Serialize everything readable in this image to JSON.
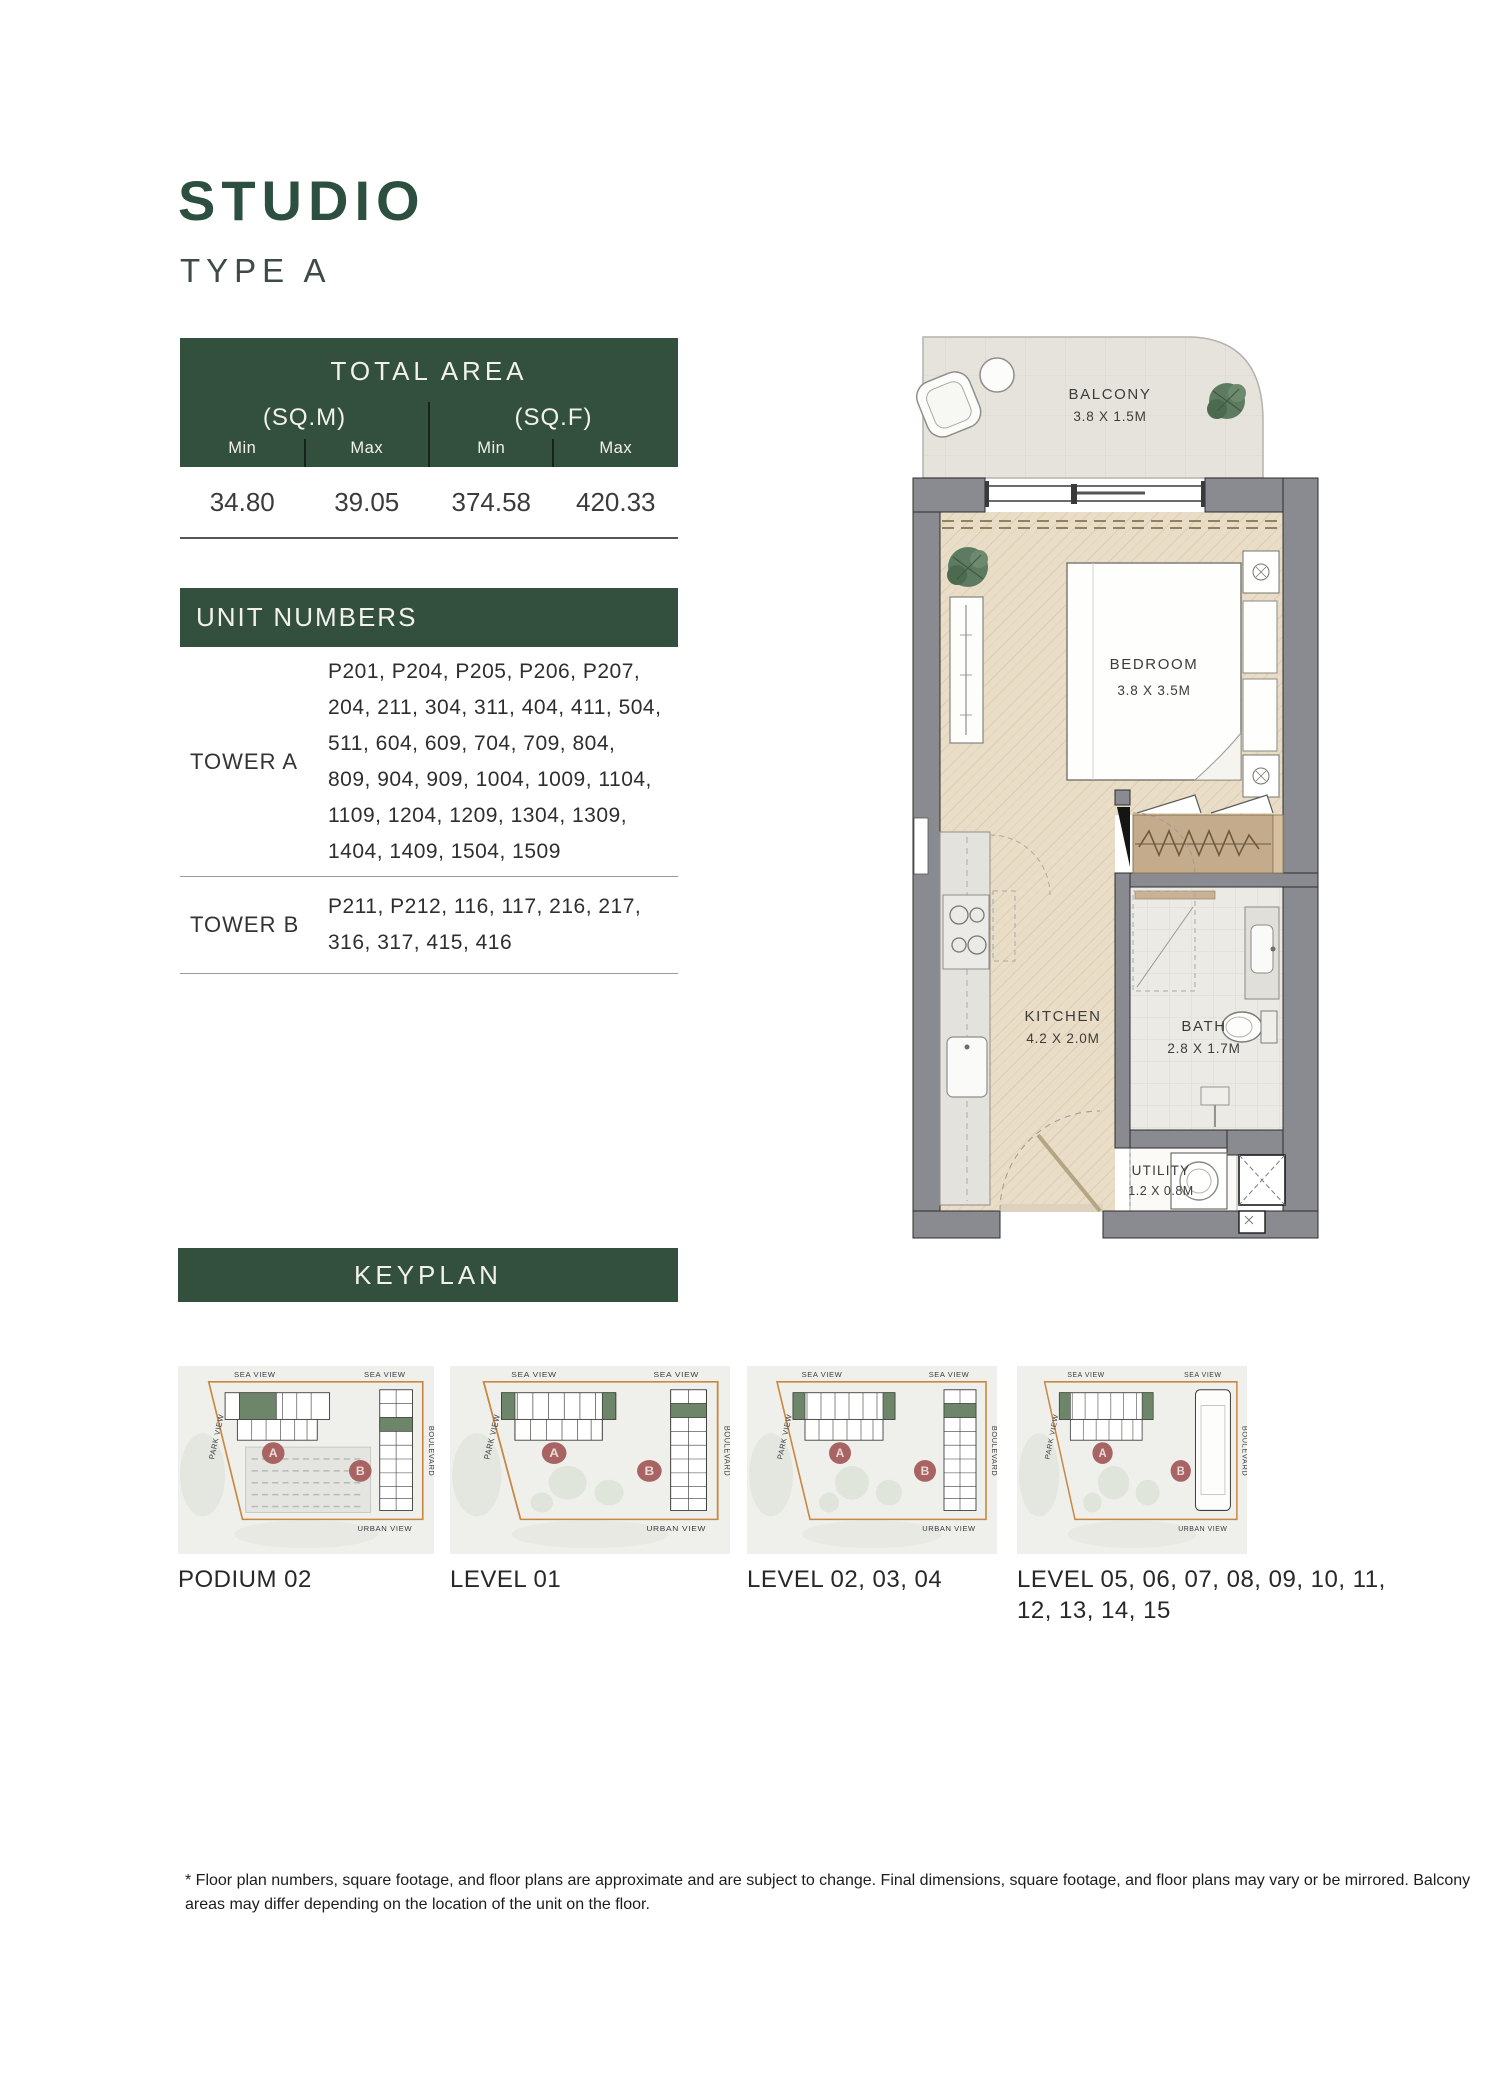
{
  "page": {
    "title": "STUDIO",
    "subtitle": "TYPE A"
  },
  "total_area": {
    "header": "TOTAL AREA",
    "unit_groups": [
      {
        "label": "(SQ.M)"
      },
      {
        "label": "(SQ.F)"
      }
    ],
    "col_headers": [
      "Min",
      "Max",
      "Min",
      "Max"
    ],
    "values": [
      "34.80",
      "39.05",
      "374.58",
      "420.33"
    ]
  },
  "unit_numbers": {
    "header": "UNIT NUMBERS",
    "rows": [
      {
        "tower": "TOWER A",
        "lines": [
          "P201, P204, P205, P206, P207,",
          "204, 211, 304, 311, 404, 411, 504,",
          "511, 604, 609, 704, 709, 804,",
          "809, 904, 909, 1004, 1009, 1104,",
          "1109, 1204, 1209, 1304, 1309,",
          "1404, 1409, 1504, 1509"
        ]
      },
      {
        "tower": "TOWER B",
        "lines": [
          "P211, P212, 116, 117, 216, 217,",
          "316, 317, 415, 416"
        ]
      }
    ]
  },
  "floor_plan": {
    "rooms": [
      {
        "name": "BALCONY",
        "dims": "3.8 X 1.5M"
      },
      {
        "name": "BEDROOM",
        "dims": "3.8 X 3.5M"
      },
      {
        "name": "KITCHEN",
        "dims": "4.2 X 2.0M"
      },
      {
        "name": "BATH",
        "dims": "2.8 X 1.7M"
      },
      {
        "name": "UTILITY",
        "dims": "1.2 X 0.8M"
      }
    ]
  },
  "keyplan": {
    "header": "KEYPLAN",
    "views": {
      "sea": "SEA VIEW",
      "park": "PARK VIEW",
      "boulevard": "BOULEVARD",
      "urban": "URBAN VIEW"
    },
    "badges": {
      "a": "A",
      "b": "B"
    },
    "cards": [
      {
        "label": "PODIUM 02"
      },
      {
        "label": "LEVEL 01"
      },
      {
        "label": "LEVEL 02, 03, 04"
      },
      {
        "label": "LEVEL 05, 06, 07, 08, 09, 10, 11,",
        "label2": "12, 13, 14, 15"
      }
    ]
  },
  "footer": {
    "line1": "* Floor plan numbers, square footage, and floor plans are approximate and are subject to change. Final dimensions, square footage, and floor plans may vary or be mirrored. Balcony",
    "line2": "areas may differ depending on the location of the unit on the floor."
  },
  "colors": {
    "green": "#33503F",
    "badge": "#A86463",
    "keyplan_outline": "#C9873F",
    "wall": "#8A8B90",
    "floor": "#E8DCC6"
  }
}
